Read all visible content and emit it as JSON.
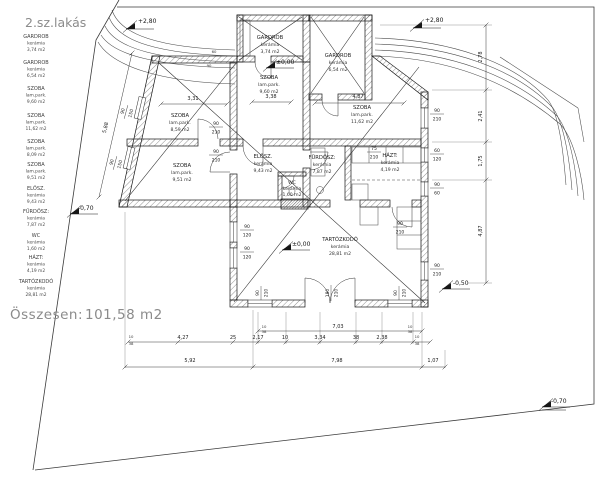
{
  "title": "2.sz.lakás",
  "legend": {
    "items": [
      {
        "name": "GARDROB",
        "material": "kerámia",
        "area": "3,74  m2"
      },
      {
        "name": "GARDROB",
        "material": "kerámia",
        "area": "6,54  m2"
      },
      {
        "name": "SZOBA",
        "material": "lam.park.",
        "area": "9,60  m2"
      },
      {
        "name": "SZOBA",
        "material": "lam.park.",
        "area": "11,62  m2"
      },
      {
        "name": "SZOBA",
        "material": "lam.park.",
        "area": "8,09  m2"
      },
      {
        "name": "SZOBA",
        "material": "lam.park.",
        "area": "9,51  m2"
      },
      {
        "name": "ELŐSZ.",
        "material": "kerámia",
        "area": "9,43  m2"
      },
      {
        "name": "FÜRDŐSZ:",
        "material": "kerámia",
        "area": "7,87  m2"
      },
      {
        "name": "WC",
        "material": "kerámia",
        "area": "1,60  m2"
      },
      {
        "name": "HÁZT:",
        "material": "kerámia",
        "area": "4,19  m2"
      },
      {
        "name": "TARTÓZKODÓ",
        "material": "kerámia",
        "area": "28,81  m2"
      }
    ]
  },
  "total": {
    "label": "Összesen:",
    "value": "101,58  m2"
  },
  "rooms": {
    "gardrob1": {
      "name": "GARDROB",
      "material": "kerámia",
      "area": "3,74  m2"
    },
    "gardrob2": {
      "name": "GARDROB",
      "material": "kerámia",
      "area": "6,54  m2"
    },
    "szoba_felso": {
      "name": "SZOBA",
      "material": "lam.park.",
      "area": "9,60  m2"
    },
    "szoba_jobb": {
      "name": "SZOBA",
      "material": "lam.park.",
      "area": "11,62  m2"
    },
    "szoba_bal_felso": {
      "name": "SZOBA",
      "material": "lam.park.",
      "area": "8,59  m2"
    },
    "szoba_bal_also": {
      "name": "SZOBA",
      "material": "lam.park.",
      "area": "9,51  m2"
    },
    "elosz": {
      "name": "ELŐSZ.",
      "material": "kerámia",
      "area": "9,43  m2"
    },
    "furdosz": {
      "name": "FÜRDŐSZ:",
      "material": "kerámia",
      "area": "7,87  m2"
    },
    "wc": {
      "name": "WC",
      "material": "kerámia",
      "area": "1,60 m2"
    },
    "hazt": {
      "name": "HÁZT:",
      "material": "kerámia",
      "area": "4,19  m2"
    },
    "tartozkodo": {
      "name": "TARTÓZKODÓ",
      "material": "kerámia",
      "area": "28,81  m2"
    }
  },
  "levels": {
    "top": "+2,80",
    "zero": "±0,00",
    "left": "-0,70",
    "right": "-0,50",
    "corner": "-0,70"
  },
  "dims": {
    "a331": "3,31",
    "a338": "3,38",
    "a487": "4,87",
    "a588": "5,88",
    "v278": "2,78",
    "v241": "2,41",
    "v175": "1,75",
    "v487": "4,87",
    "b703": "7,03",
    "b427": "4,27",
    "b25": "25",
    "b217": "2,17",
    "b10": "10",
    "b334": "3,34",
    "b38": "38",
    "b238": "2,38",
    "c592": "5,92",
    "c798": "7,98",
    "c107": "1,07",
    "s60": "60",
    "s90": "90",
    "s10": "10",
    "s38": "38"
  },
  "openings": {
    "o90": "90",
    "o210": "210",
    "o60": "60",
    "o120": "120",
    "o150": "150",
    "o180": "180",
    "o75": "75"
  }
}
